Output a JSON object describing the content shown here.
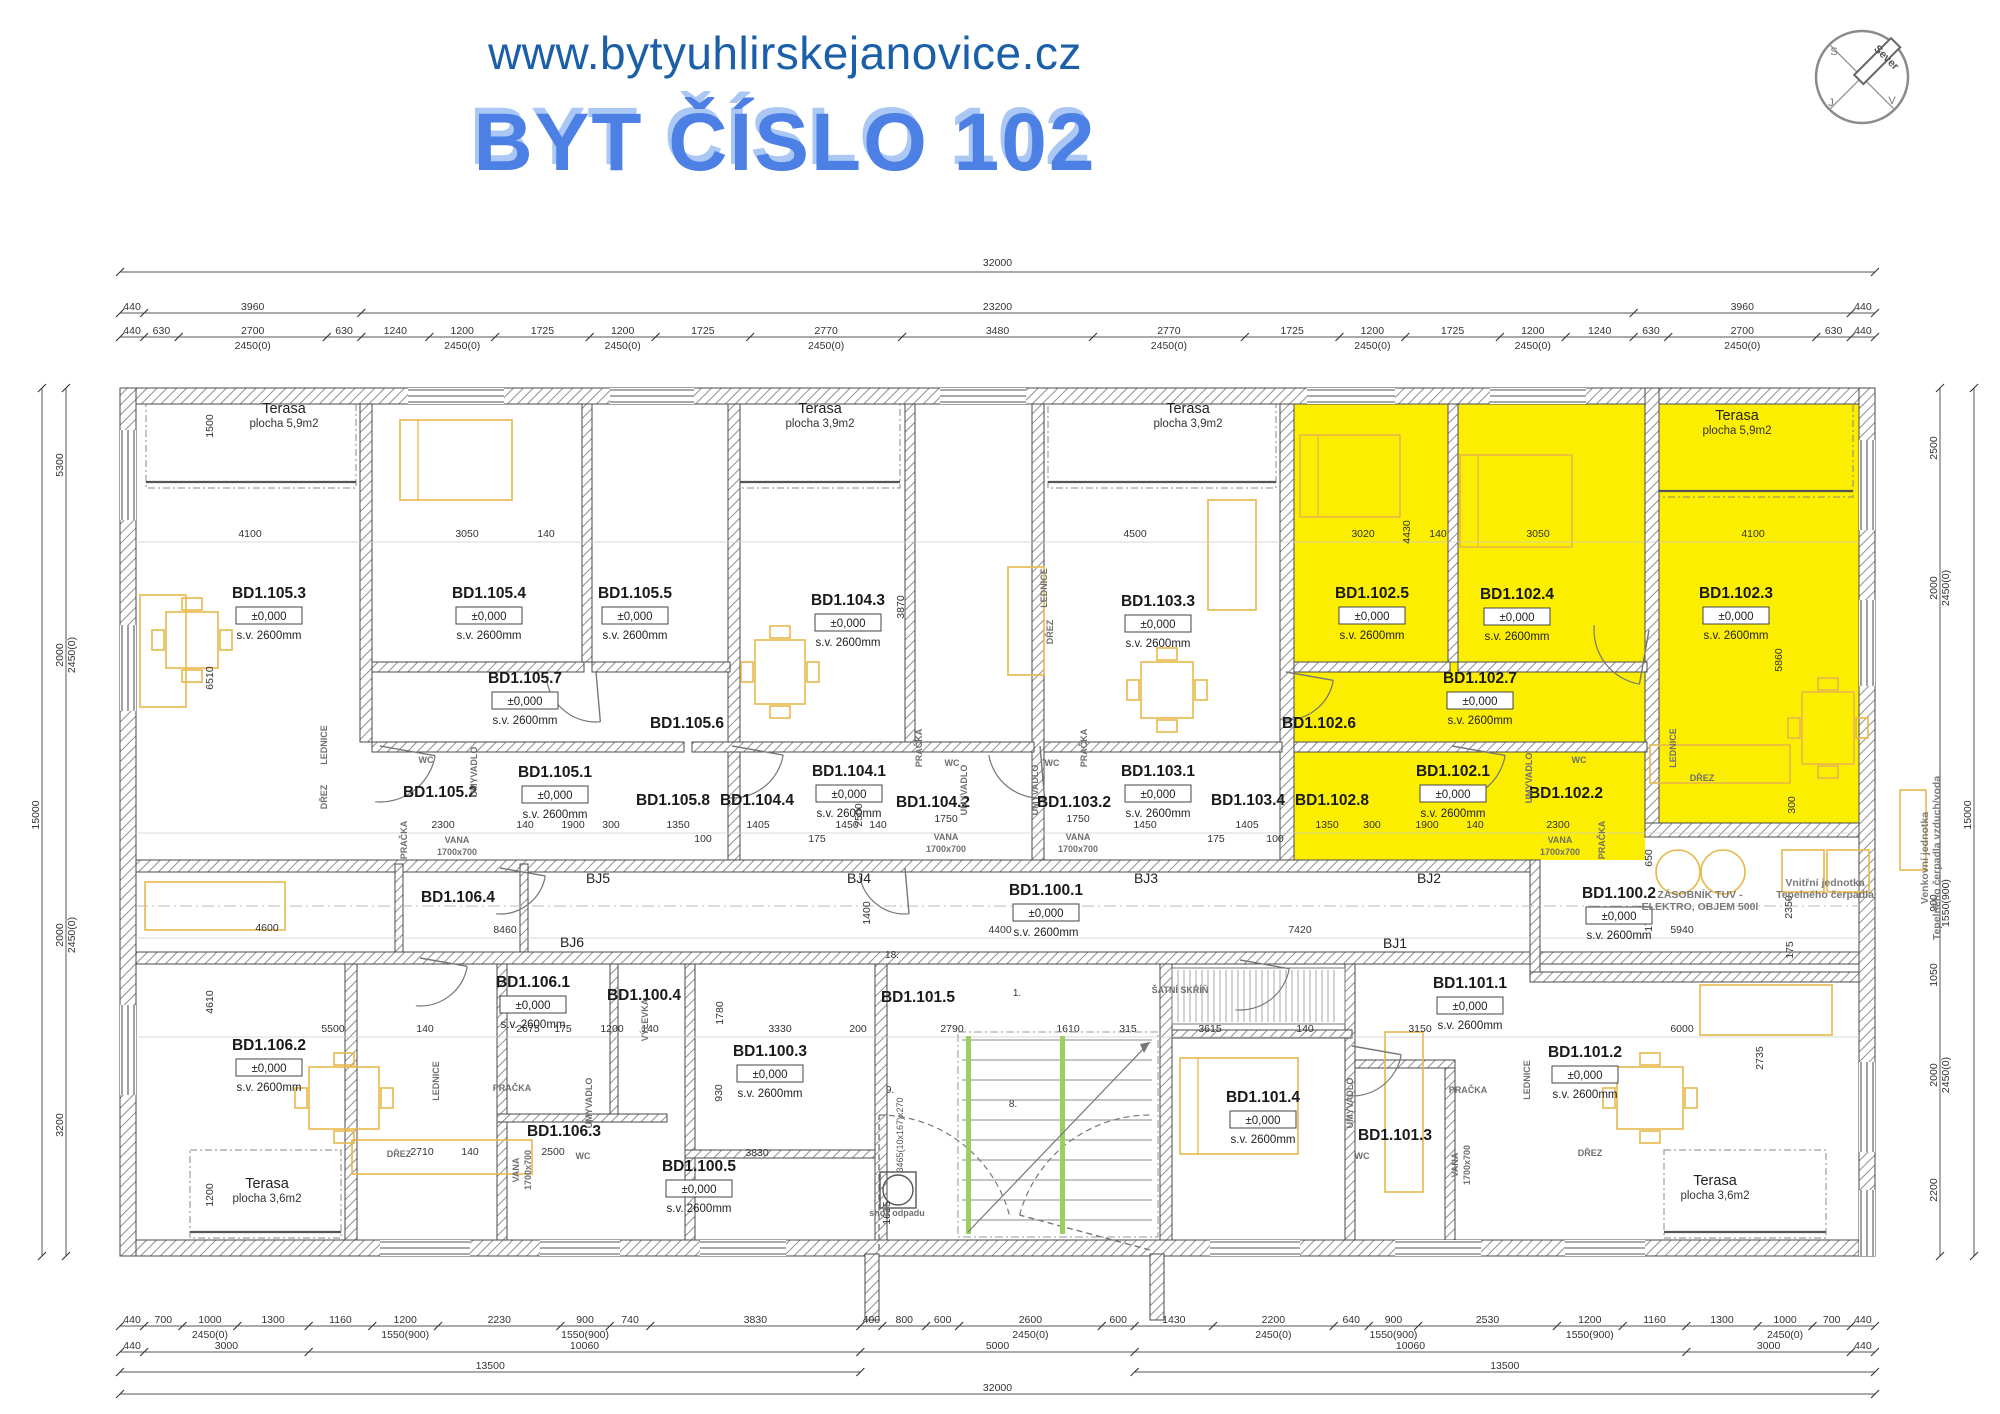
{
  "header": {
    "url": "www.bytyuhlirskejanovice.cz",
    "title": "BYT ČÍSLO 102"
  },
  "compass": {
    "needle_label": "Sever",
    "letters": [
      {
        "t": "S",
        "x": 1834,
        "y": 55
      },
      {
        "t": "J",
        "x": 1831,
        "y": 106
      },
      {
        "t": "V",
        "x": 1892,
        "y": 104
      }
    ]
  },
  "defaults": {
    "elevation": "±0,000",
    "clear_height": "s.v. 2600mm"
  },
  "highlight_color": "#FCEE00",
  "rooms": [
    {
      "id": "BD1.105.3",
      "x": 269,
      "y": 598,
      "full": true
    },
    {
      "id": "BD1.105.4",
      "x": 489,
      "y": 598,
      "full": true
    },
    {
      "id": "BD1.105.5",
      "x": 635,
      "y": 598,
      "full": true
    },
    {
      "id": "BD1.104.3",
      "x": 848,
      "y": 605,
      "full": true
    },
    {
      "id": "BD1.103.3",
      "x": 1158,
      "y": 606,
      "full": true
    },
    {
      "id": "BD1.102.5",
      "x": 1372,
      "y": 598,
      "full": true
    },
    {
      "id": "BD1.102.4",
      "x": 1517,
      "y": 599,
      "full": true
    },
    {
      "id": "BD1.102.3",
      "x": 1736,
      "y": 598,
      "full": true
    },
    {
      "id": "BD1.105.7",
      "x": 525,
      "y": 683,
      "full": true
    },
    {
      "id": "BD1.102.7",
      "x": 1480,
      "y": 683,
      "full": true
    },
    {
      "id": "BD1.105.6",
      "x": 687,
      "y": 728,
      "full": false
    },
    {
      "id": "BD1.102.6",
      "x": 1319,
      "y": 728,
      "full": false
    },
    {
      "id": "BD1.105.2",
      "x": 440,
      "y": 797,
      "full": false
    },
    {
      "id": "BD1.105.1",
      "x": 555,
      "y": 777,
      "full": true
    },
    {
      "id": "BD1.105.8",
      "x": 673,
      "y": 805,
      "full": false
    },
    {
      "id": "BD1.104.4",
      "x": 757,
      "y": 805,
      "full": false
    },
    {
      "id": "BD1.104.1",
      "x": 849,
      "y": 776,
      "full": true
    },
    {
      "id": "BD1.104.2",
      "x": 933,
      "y": 807,
      "full": false
    },
    {
      "id": "BD1.103.2",
      "x": 1074,
      "y": 807,
      "full": false
    },
    {
      "id": "BD1.103.1",
      "x": 1158,
      "y": 776,
      "full": true
    },
    {
      "id": "BD1.103.4",
      "x": 1248,
      "y": 805,
      "full": false
    },
    {
      "id": "BD1.102.8",
      "x": 1332,
      "y": 805,
      "full": false
    },
    {
      "id": "BD1.102.1",
      "x": 1453,
      "y": 776,
      "full": true
    },
    {
      "id": "BD1.102.2",
      "x": 1566,
      "y": 798,
      "full": false
    },
    {
      "id": "BD1.100.1",
      "x": 1046,
      "y": 895,
      "full": true
    },
    {
      "id": "BD1.100.2",
      "x": 1619,
      "y": 898,
      "full": true
    },
    {
      "id": "BD1.106.4",
      "x": 458,
      "y": 902,
      "full": false
    },
    {
      "id": "BD1.106.1",
      "x": 533,
      "y": 987,
      "full": true
    },
    {
      "id": "BD1.106.2",
      "x": 269,
      "y": 1050,
      "full": true
    },
    {
      "id": "BD1.106.3",
      "x": 564,
      "y": 1136,
      "full": false
    },
    {
      "id": "BD1.100.4",
      "x": 644,
      "y": 1000,
      "full": false
    },
    {
      "id": "BD1.100.3",
      "x": 770,
      "y": 1056,
      "full": true
    },
    {
      "id": "BD1.100.5",
      "x": 699,
      "y": 1171,
      "full": true
    },
    {
      "id": "BD1.101.5",
      "x": 918,
      "y": 1002,
      "full": false
    },
    {
      "id": "BD1.101.4",
      "x": 1263,
      "y": 1102,
      "full": true
    },
    {
      "id": "BD1.101.3",
      "x": 1395,
      "y": 1140,
      "full": false
    },
    {
      "id": "BD1.101.1",
      "x": 1470,
      "y": 988,
      "full": true
    },
    {
      "id": "BD1.101.2",
      "x": 1585,
      "y": 1057,
      "full": true
    }
  ],
  "terraces": [
    {
      "name": "Terasa",
      "area": "plocha 5,9m2",
      "x": 284,
      "y": 413
    },
    {
      "name": "Terasa",
      "area": "plocha 3,9m2",
      "x": 820,
      "y": 413
    },
    {
      "name": "Terasa",
      "area": "plocha 3,9m2",
      "x": 1188,
      "y": 413
    },
    {
      "name": "Terasa",
      "area": "plocha 5,9m2",
      "x": 1737,
      "y": 420
    },
    {
      "name": "Terasa",
      "area": "plocha 3,6m2",
      "x": 267,
      "y": 1188
    },
    {
      "name": "Terasa",
      "area": "plocha 3,6m2",
      "x": 1715,
      "y": 1185
    }
  ],
  "junctions": [
    {
      "id": "BJ5",
      "x": 598,
      "y": 883
    },
    {
      "id": "BJ4",
      "x": 859,
      "y": 883
    },
    {
      "id": "BJ3",
      "x": 1146,
      "y": 883
    },
    {
      "id": "BJ2",
      "x": 1429,
      "y": 883
    },
    {
      "id": "BJ6",
      "x": 572,
      "y": 947
    },
    {
      "id": "BJ1",
      "x": 1395,
      "y": 948
    }
  ],
  "fixtures": [
    {
      "t": "LEDNICE",
      "x": 327,
      "y": 745,
      "v": true
    },
    {
      "t": "DŘEZ",
      "x": 327,
      "y": 797,
      "v": true
    },
    {
      "t": "WC",
      "x": 426,
      "y": 763
    },
    {
      "t": "UMYVADLO",
      "x": 477,
      "y": 772,
      "v": true
    },
    {
      "t": "PRAČKA",
      "x": 407,
      "y": 840,
      "v": true
    },
    {
      "t": "VANA",
      "x": 457,
      "y": 843
    },
    {
      "t": "1700x700",
      "x": 457,
      "y": 855
    },
    {
      "t": "PRAČKA",
      "x": 922,
      "y": 748,
      "v": true
    },
    {
      "t": "WC",
      "x": 952,
      "y": 766
    },
    {
      "t": "UMYVADLO",
      "x": 967,
      "y": 790,
      "v": true
    },
    {
      "t": "VANA",
      "x": 946,
      "y": 840
    },
    {
      "t": "1700x700",
      "x": 946,
      "y": 852
    },
    {
      "t": "PRAČKA",
      "x": 1087,
      "y": 748,
      "v": true
    },
    {
      "t": "WC",
      "x": 1052,
      "y": 766
    },
    {
      "t": "UMYVADLO",
      "x": 1038,
      "y": 790,
      "v": true
    },
    {
      "t": "VANA",
      "x": 1078,
      "y": 840
    },
    {
      "t": "1700x700",
      "x": 1078,
      "y": 852
    },
    {
      "t": "UMYVADLO",
      "x": 1532,
      "y": 778,
      "v": true
    },
    {
      "t": "WC",
      "x": 1579,
      "y": 763
    },
    {
      "t": "VANA",
      "x": 1560,
      "y": 843
    },
    {
      "t": "1700x700",
      "x": 1560,
      "y": 855
    },
    {
      "t": "PRAČKA",
      "x": 1605,
      "y": 840,
      "v": true
    },
    {
      "t": "LEDNICE",
      "x": 1047,
      "y": 588,
      "v": true
    },
    {
      "t": "DŘEZ",
      "x": 1053,
      "y": 632,
      "v": true
    },
    {
      "t": "LEDNICE",
      "x": 1676,
      "y": 748,
      "v": true
    },
    {
      "t": "DŘEZ",
      "x": 1702,
      "y": 781
    },
    {
      "t": "LEDNICE",
      "x": 439,
      "y": 1081,
      "v": true
    },
    {
      "t": "PRAČKA",
      "x": 512,
      "y": 1091
    },
    {
      "t": "VANA",
      "x": 519,
      "y": 1170,
      "v": true
    },
    {
      "t": "1700x700",
      "x": 531,
      "y": 1170,
      "v": true
    },
    {
      "t": "WC",
      "x": 583,
      "y": 1159
    },
    {
      "t": "UMYVADLO",
      "x": 592,
      "y": 1103,
      "v": true
    },
    {
      "t": "DŘEZ",
      "x": 399,
      "y": 1157
    },
    {
      "t": "PRAČKA",
      "x": 1468,
      "y": 1093
    },
    {
      "t": "VANA",
      "x": 1458,
      "y": 1165,
      "v": true
    },
    {
      "t": "1700x700",
      "x": 1470,
      "y": 1165,
      "v": true
    },
    {
      "t": "LEDNICE",
      "x": 1530,
      "y": 1080,
      "v": true
    },
    {
      "t": "DŘEZ",
      "x": 1590,
      "y": 1156
    },
    {
      "t": "WC",
      "x": 1362,
      "y": 1159
    },
    {
      "t": "UMYVADLO",
      "x": 1353,
      "y": 1103,
      "v": true
    },
    {
      "t": "VÝLEVKA",
      "x": 648,
      "y": 1020,
      "v": true
    },
    {
      "t": "ŠATNÍ SKŘÍŇ",
      "x": 1180,
      "y": 993
    },
    {
      "t": "shoz odpadu",
      "x": 897,
      "y": 1216
    }
  ],
  "tech_labels": [
    {
      "t": "ZÁSOBNÍK TUV -",
      "x": 1700,
      "y": 898
    },
    {
      "t": "ELEKTRO, OBJEM 500l",
      "x": 1700,
      "y": 910
    },
    {
      "t": "Vnitřní jednotka",
      "x": 1825,
      "y": 886
    },
    {
      "t": "Tepelného čerpadla",
      "x": 1825,
      "y": 898
    },
    {
      "t": "Venkovní jednotka",
      "x": 1928,
      "y": 858,
      "v": true
    },
    {
      "t": "Tepelného čerpadla vzduch/voda",
      "x": 1940,
      "y": 858,
      "v": true
    }
  ],
  "stairs": {
    "labels": [
      {
        "t": "18.",
        "x": 892,
        "y": 958
      },
      {
        "t": "1.",
        "x": 1017,
        "y": 996
      },
      {
        "t": "8.",
        "x": 1013,
        "y": 1107
      },
      {
        "t": "9.",
        "x": 890,
        "y": 1093
      }
    ],
    "flight": {
      "t": "3465(10x167)x270",
      "x": 903,
      "y": 1135
    }
  },
  "dims": {
    "top_total": {
      "t": "32000",
      "y": 268
    },
    "top_row1": {
      "y": 313,
      "segs": [
        [
          "440"
        ],
        [
          "3960"
        ],
        [
          "23200"
        ],
        [
          "3960"
        ],
        [
          "440"
        ]
      ]
    },
    "top_row2": {
      "y": 337,
      "segs": [
        [
          "440"
        ],
        [
          "630"
        ],
        [
          "2700",
          "2450(0)"
        ],
        [
          "630"
        ],
        [
          "1240"
        ],
        [
          "1200",
          "2450(0)"
        ],
        [
          "1725"
        ],
        [
          "1200",
          "2450(0)"
        ],
        [
          "1725"
        ],
        [
          "2770",
          "2450(0)"
        ],
        [
          "3480"
        ],
        [
          "2770",
          "2450(0)"
        ],
        [
          "1725"
        ],
        [
          "1200",
          "2450(0)"
        ],
        [
          "1725"
        ],
        [
          "1200",
          "2450(0)"
        ],
        [
          "1240"
        ],
        [
          "630"
        ],
        [
          "2700",
          "2450(0)"
        ],
        [
          "630"
        ],
        [
          "440"
        ]
      ]
    },
    "bottom_row1": {
      "y": 1326,
      "segs": [
        [
          "440"
        ],
        [
          "700"
        ],
        [
          "1000",
          "2450(0)"
        ],
        [
          "1300"
        ],
        [
          "1160"
        ],
        [
          "1200",
          "1550(900)"
        ],
        [
          "2230"
        ],
        [
          "900",
          "1550(900)"
        ],
        [
          "740"
        ],
        [
          "3830"
        ],
        [
          "400"
        ],
        [
          "800"
        ],
        [
          "600"
        ],
        [
          "2600",
          "2450(0)"
        ],
        [
          "600"
        ],
        [
          "1430"
        ],
        [
          "2200",
          "2450(0)"
        ],
        [
          "640"
        ],
        [
          "900",
          "1550(900)"
        ],
        [
          "2530"
        ],
        [
          "1200",
          "1550(900)"
        ],
        [
          "1160"
        ],
        [
          "1300"
        ],
        [
          "1000",
          "2450(0)"
        ],
        [
          "700"
        ],
        [
          "440"
        ]
      ]
    },
    "bottom_row2": {
      "y": 1352,
      "segs": [
        [
          "440"
        ],
        [
          "3000"
        ],
        [
          "10060"
        ],
        [
          "5000"
        ],
        [
          "10060"
        ],
        [
          "3000"
        ],
        [
          "440"
        ]
      ]
    },
    "bottom_row3": {
      "y": 1372,
      "spans": [
        {
          "t": "13500",
          "mm0": 0,
          "mm1": 13500
        },
        {
          "t": "13500",
          "mm0": 18500,
          "mm1": 32000
        }
      ]
    },
    "bottom_row4": {
      "y": 1394,
      "t": "32000"
    },
    "left_outer": {
      "x": 42,
      "t": "15000",
      "y": 815
    },
    "right_outer": {
      "x": 1974,
      "t": "15000",
      "y": 815
    },
    "left_col": {
      "x": 66,
      "items": [
        {
          "t": "5300",
          "y": 465
        },
        {
          "t": "2000",
          "s": "2450(0)",
          "y": 655
        },
        {
          "t": "2000",
          "s": "2450(0)",
          "y": 935
        },
        {
          "t": "3200",
          "y": 1125
        }
      ]
    },
    "right_col": {
      "x": 1940,
      "items": [
        {
          "t": "2500",
          "y": 448
        },
        {
          "t": "2000",
          "s": "2450(0)",
          "y": 588
        },
        {
          "t": "900",
          "s": "1550(900)",
          "y": 903
        },
        {
          "t": "1050",
          "y": 975
        },
        {
          "t": "2000",
          "s": "2450(0)",
          "y": 1075
        },
        {
          "t": "2200",
          "y": 1190
        }
      ]
    },
    "inner": [
      {
        "t": "4100",
        "x": 250,
        "y": 537
      },
      {
        "t": "3050",
        "x": 467,
        "y": 537
      },
      {
        "t": "140",
        "x": 546,
        "y": 537
      },
      {
        "t": "4500",
        "x": 1135,
        "y": 537
      },
      {
        "t": "3020",
        "x": 1363,
        "y": 537
      },
      {
        "t": "140",
        "x": 1438,
        "y": 537
      },
      {
        "t": "3050",
        "x": 1538,
        "y": 537
      },
      {
        "t": "4100",
        "x": 1753,
        "y": 537
      },
      {
        "t": "1500",
        "x": 213,
        "y": 426,
        "v": true
      },
      {
        "t": "6510",
        "x": 213,
        "y": 678,
        "v": true
      },
      {
        "t": "3870",
        "x": 904,
        "y": 607,
        "v": true
      },
      {
        "t": "4430",
        "x": 1410,
        "y": 532,
        "v": true
      },
      {
        "t": "5860",
        "x": 1782,
        "y": 660,
        "v": true
      },
      {
        "t": "300",
        "x": 1795,
        "y": 805,
        "v": true
      },
      {
        "t": "2300",
        "x": 443,
        "y": 828
      },
      {
        "t": "140",
        "x": 525,
        "y": 828
      },
      {
        "t": "1900",
        "x": 573,
        "y": 828
      },
      {
        "t": "300",
        "x": 611,
        "y": 828
      },
      {
        "t": "1350",
        "x": 678,
        "y": 828
      },
      {
        "t": "100",
        "x": 703,
        "y": 842
      },
      {
        "t": "1405",
        "x": 758,
        "y": 828
      },
      {
        "t": "175",
        "x": 817,
        "y": 842
      },
      {
        "t": "1450",
        "x": 847,
        "y": 828
      },
      {
        "t": "140",
        "x": 878,
        "y": 828
      },
      {
        "t": "1750",
        "x": 946,
        "y": 822
      },
      {
        "t": "1750",
        "x": 1078,
        "y": 822
      },
      {
        "t": "1450",
        "x": 1145,
        "y": 828
      },
      {
        "t": "175",
        "x": 1216,
        "y": 842
      },
      {
        "t": "1405",
        "x": 1247,
        "y": 828
      },
      {
        "t": "100",
        "x": 1275,
        "y": 842
      },
      {
        "t": "1350",
        "x": 1327,
        "y": 828
      },
      {
        "t": "300",
        "x": 1372,
        "y": 828
      },
      {
        "t": "1900",
        "x": 1427,
        "y": 828
      },
      {
        "t": "140",
        "x": 1475,
        "y": 828
      },
      {
        "t": "2300",
        "x": 1558,
        "y": 828
      },
      {
        "t": "2500",
        "x": 862,
        "y": 815,
        "v": true
      },
      {
        "t": "1400",
        "x": 870,
        "y": 913,
        "v": true
      },
      {
        "t": "650",
        "x": 1652,
        "y": 858,
        "v": true
      },
      {
        "t": "1700",
        "x": 1652,
        "y": 920,
        "v": true
      },
      {
        "t": "2350",
        "x": 1792,
        "y": 907,
        "v": true
      },
      {
        "t": "175",
        "x": 1793,
        "y": 950,
        "v": true
      },
      {
        "t": "8460",
        "x": 505,
        "y": 933
      },
      {
        "t": "4400",
        "x": 1000,
        "y": 933
      },
      {
        "t": "7420",
        "x": 1300,
        "y": 933
      },
      {
        "t": "5940",
        "x": 1682,
        "y": 933
      },
      {
        "t": "4600",
        "x": 267,
        "y": 931
      },
      {
        "t": "5500",
        "x": 333,
        "y": 1032
      },
      {
        "t": "140",
        "x": 425,
        "y": 1032
      },
      {
        "t": "2675",
        "x": 528,
        "y": 1032
      },
      {
        "t": "175",
        "x": 563,
        "y": 1032
      },
      {
        "t": "1200",
        "x": 612,
        "y": 1032
      },
      {
        "t": "140",
        "x": 650,
        "y": 1032
      },
      {
        "t": "3330",
        "x": 780,
        "y": 1032
      },
      {
        "t": "200",
        "x": 858,
        "y": 1032
      },
      {
        "t": "2790",
        "x": 952,
        "y": 1032
      },
      {
        "t": "1610",
        "x": 1068,
        "y": 1032
      },
      {
        "t": "315",
        "x": 1128,
        "y": 1032
      },
      {
        "t": "3615",
        "x": 1210,
        "y": 1032
      },
      {
        "t": "140",
        "x": 1305,
        "y": 1032
      },
      {
        "t": "3150",
        "x": 1420,
        "y": 1032
      },
      {
        "t": "6000",
        "x": 1682,
        "y": 1032
      },
      {
        "t": "2710",
        "x": 422,
        "y": 1155
      },
      {
        "t": "140",
        "x": 470,
        "y": 1155
      },
      {
        "t": "2500",
        "x": 553,
        "y": 1155
      },
      {
        "t": "3830",
        "x": 757,
        "y": 1156
      },
      {
        "t": "4610",
        "x": 213,
        "y": 1002,
        "v": true
      },
      {
        "t": "1200",
        "x": 213,
        "y": 1195,
        "v": true
      },
      {
        "t": "1780",
        "x": 723,
        "y": 1013,
        "v": true
      },
      {
        "t": "930",
        "x": 722,
        "y": 1093,
        "v": true
      },
      {
        "t": "2735",
        "x": 1763,
        "y": 1058,
        "v": true
      },
      {
        "t": "1615",
        "x": 890,
        "y": 1213,
        "v": true
      }
    ]
  }
}
